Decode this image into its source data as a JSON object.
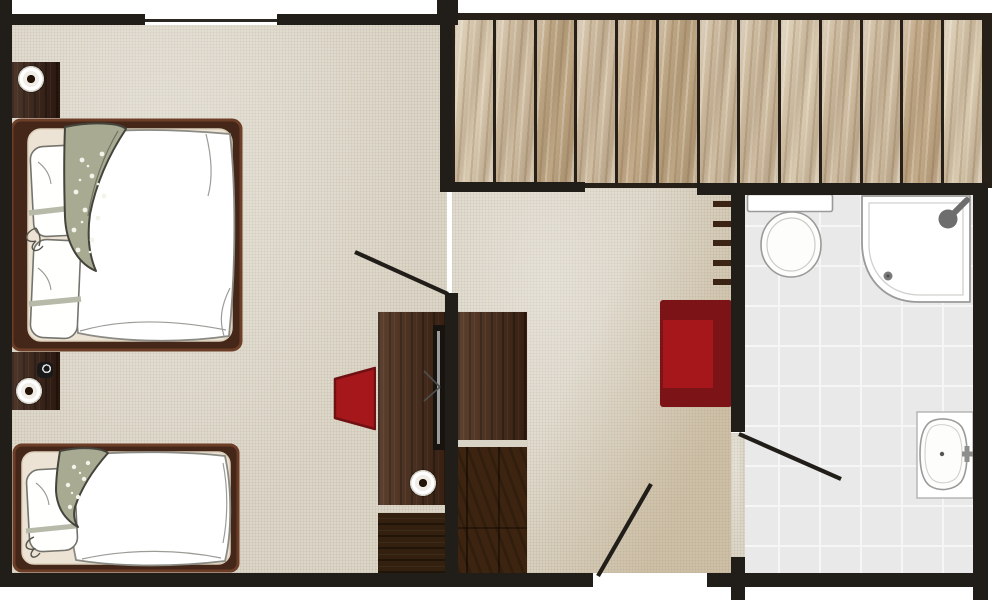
{
  "plan": {
    "kind": "floor-plan",
    "subject": "hotel room: bedroom and living area with wooden deck and en-suite bathroom",
    "rooms": [
      "bedroom-living-area",
      "wooden-deck",
      "bathroom"
    ],
    "furniture": [
      "double-bed",
      "single-bed",
      "nightstand-with-lamp",
      "nightstand-with-lamp-and-clock",
      "tv-desk",
      "desk-chair",
      "wardrobe",
      "lounge-chair",
      "wall-ladder"
    ],
    "fixtures": [
      "toilet",
      "corner-shower",
      "washbasin-with-faucet"
    ],
    "openings": [
      "window",
      "bedroom-door",
      "bathroom-door",
      "entry-door"
    ]
  },
  "deck": {
    "plank_count": 13
  },
  "ladder": {
    "rung_count": 5
  },
  "palette": {
    "wall": "#211d18",
    "window_line": "#2b2722",
    "floor_base": "#dcd6c8",
    "deck_border": "#262019",
    "plank_a": "#cfbda2",
    "plank_b": "#bda684",
    "plank_c": "#d8c9af",
    "tile": "#e9e9ea",
    "grout": "#f6f6f7",
    "wood_a": "#4b2b17",
    "wood_b": "#33200e",
    "bed_frame": "#45271a",
    "bed_frame_edge": "#6d3e27",
    "mattress": "#ece3d4",
    "linen": "#ffffff",
    "linen_line": "#8b8b85",
    "blanket": "#a8ab92",
    "blanket_line": "#44443c",
    "red_bright": "#a6171c",
    "red_dark": "#7c1417",
    "fixture_line": "#9a9a98",
    "metal": "#6e6e6e"
  }
}
